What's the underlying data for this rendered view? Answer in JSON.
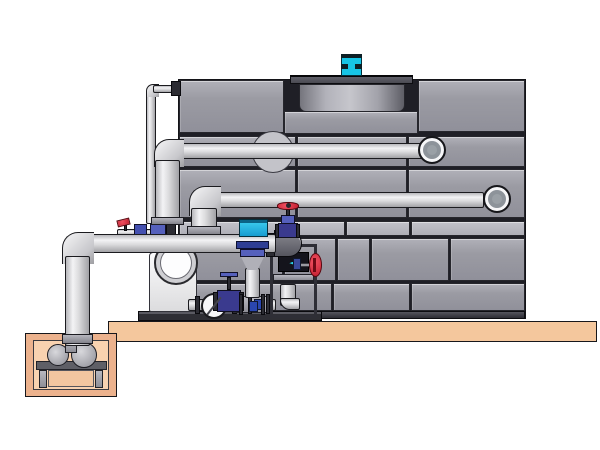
{
  "diagram": {
    "title": "cooling-tower-pump-skid-piping-illustration",
    "background": "#ffffff",
    "colors": {
      "casing_panel_gray": "#9b9ba3",
      "panel_joint_dark": "#26262c",
      "pipe_light_gray": "#e6e6e8",
      "pipe_outline": "#1b1b1f",
      "fan_cowl_gray": "#4a4a52",
      "motor_cyan": "#17c5e6",
      "controller_cyan": "#2cc0ea",
      "valve_red": "#d42838",
      "valve_navy": "#3a3a8e",
      "valve_blue": "#5560bc",
      "slab_tan": "#f4c79d",
      "pit_wall_tan": "#ecb28d",
      "pit_floor_tan": "#f8d2b0",
      "meter_display_dark": "#14141c",
      "meter_arrow_cyan": "#2ad8f0"
    },
    "components": {
      "tower_casing": "paneled cooling tower casing, 6 tiers of gray panels",
      "fan_cowl": "recessed fan cowl drum on tower roof",
      "fan_motor": "cyan fan motor on cowl",
      "upper_pipe": "upper supply pipe entering casing via elbow",
      "middle_pipe": "middle return pipe entering casing via elbow",
      "lower_pipe": "lower suction pipe from sump pit to skid",
      "makeup_line": "thin makeup water line from casing top to skid",
      "pump": "end-suction pump with circular inlet",
      "gate_valve_red": "red handwheel gate valve on riser",
      "side_valve_red": "red handwheel valve on meter stand",
      "lever_valve_red": "small red lever ball valve",
      "control_valve_blue": "blue flanged control valve with cone",
      "controller_box_cyan": "cyan controller box",
      "check_valve": "wafer check valve disc",
      "meter_stand": "instrument stand with flow meter display",
      "skid_base": "dark equipment skid base on slab",
      "slab": "concrete slab (tan)",
      "sump_pit": "sump pit with small pump on stand"
    }
  },
  "icons": {
    "meter_arrow": "◄"
  }
}
